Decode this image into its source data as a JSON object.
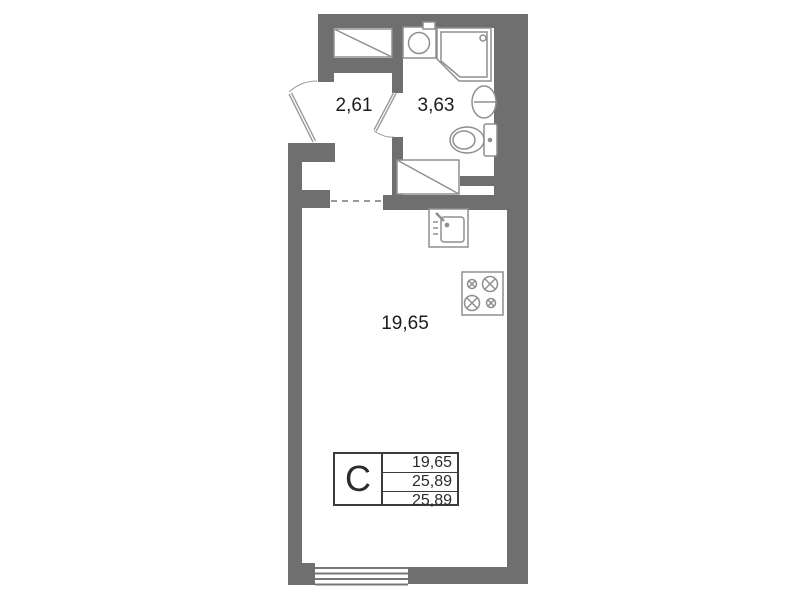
{
  "plan_title": "studio-floor-plan",
  "rooms": {
    "hallway": {
      "area": "2,61"
    },
    "bathroom": {
      "area": "3,63"
    },
    "living": {
      "area": "19,65"
    }
  },
  "info_table": {
    "unit_type": "С",
    "rows": [
      "19,65",
      "25,89",
      "25,89"
    ]
  },
  "icons": [
    "closet-icon",
    "bath-sink-icon",
    "shower-cabin-icon",
    "washbasin-icon",
    "toilet-icon",
    "washing-machine-icon",
    "kitchen-sink-icon",
    "stove-icon",
    "entrance-door-icon",
    "bathroom-door-icon",
    "window-icon",
    "opening-dashed-line"
  ],
  "colors": {
    "wall": "#6f6f6f",
    "fixture_line": "#8f8f8f",
    "table_border": "#3c3c3c",
    "text": "#1c1c1c",
    "background": "#ffffff"
  }
}
